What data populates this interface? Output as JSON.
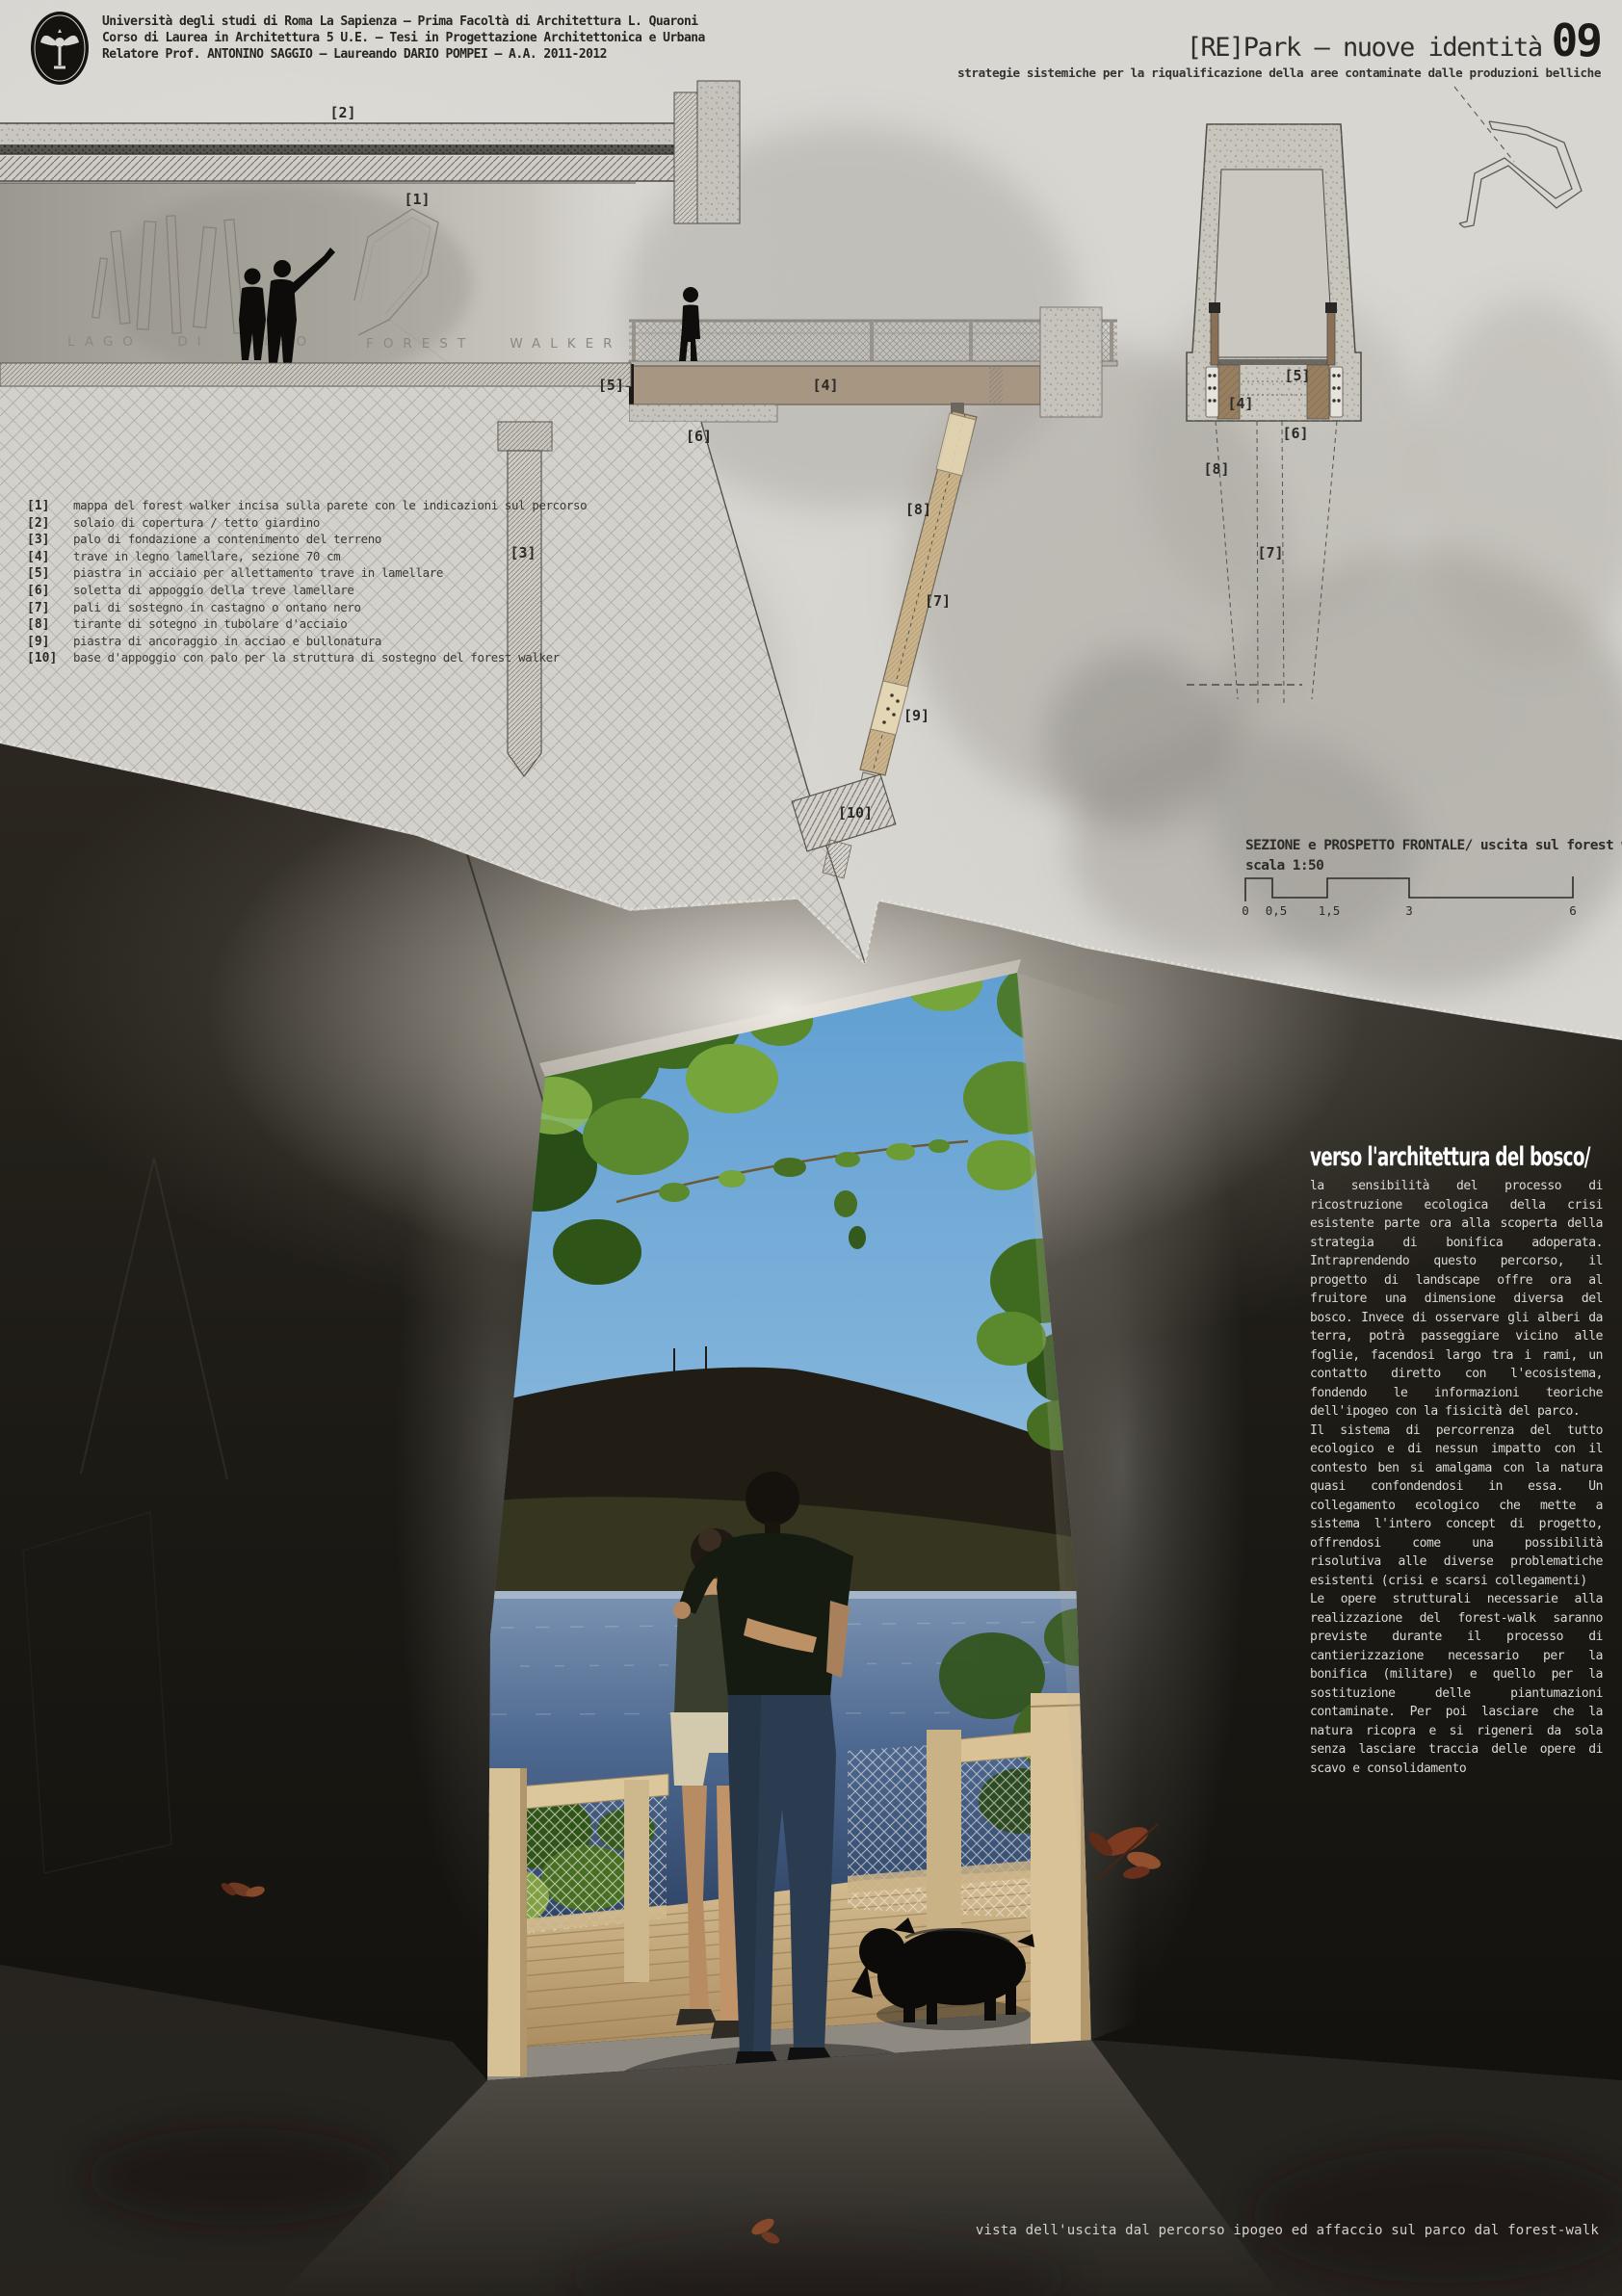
{
  "header": {
    "line1": "Università degli studi di Roma La Sapienza – Prima Facoltà di Architettura L. Quaroni",
    "line2": "Corso di Laurea in Architettura 5 U.E. – Tesi in Progettazione Architettonica e Urbana",
    "line3": "Relatore Prof. ANTONINO SAGGIO – Laureando DARIO POMPEI – A.A. 2011-2012",
    "title": "[RE]Park – nuove identità",
    "title_number": "09",
    "subtitle": "strategie sistemiche per la riqualificazione della aree contaminate dalle produzioni belliche"
  },
  "drawing": {
    "site_label_left": "LAGO DI VICO",
    "site_label_right": "FOREST WALKER",
    "callouts": {
      "c1": "[1]",
      "c2": "[2]",
      "c3": "[3]",
      "c4": "[4]",
      "c5": "[5]",
      "c6": "[6]",
      "c7": "[7]",
      "c8": "[8]",
      "c9": "[9]",
      "c10": "[10]"
    },
    "portal_callouts": {
      "p4": "[4]",
      "p5": "[5]",
      "p6": "[6]",
      "p7": "[7]",
      "p8": "[8]"
    },
    "caption_line1": "SEZIONE e PROSPETTO FRONTALE/ uscita sul forest walker",
    "caption_line2": "scala 1:50",
    "scale_ticks": [
      "0",
      "0,5",
      "1,5",
      "3",
      "6"
    ]
  },
  "legend": {
    "items": [
      {
        "num": "[1]",
        "text": "mappa del forest walker incisa sulla parete con le indicazioni sul percorso"
      },
      {
        "num": "[2]",
        "text": "solaio di copertura / tetto giardino"
      },
      {
        "num": "[3]",
        "text": "palo di fondazione a contenimento del terreno"
      },
      {
        "num": "[4]",
        "text": "trave in legno lamellare, sezione 70 cm"
      },
      {
        "num": "[5]",
        "text": "piastra in acciaio per allettamento trave in lamellare"
      },
      {
        "num": "[6]",
        "text": "soletta di appoggio della treve lamellare"
      },
      {
        "num": "[7]",
        "text": "pali di sostegno in castagno o ontano nero"
      },
      {
        "num": "[8]",
        "text": "tirante di sotegno in tubolare d'acciaio"
      },
      {
        "num": "[9]",
        "text": "piastra di ancoraggio in acciao e bullonatura"
      },
      {
        "num": "[10]",
        "text": "base d'appoggio con palo per la struttura di sostegno del forest walker"
      }
    ]
  },
  "essay": {
    "heading": "verso l'architettura del bosco/",
    "paragraphs": [
      "la sensibilità del processo di ricostruzione ecologica della crisi esistente parte ora alla scoperta della strategia di bonifica adoperata. Intraprendendo questo percorso, il progetto di landscape offre ora al fruitore una dimensione diversa del bosco. Invece di osservare gli alberi da terra, potrà passeggiare vicino alle foglie, facendosi largo tra i rami, un contatto diretto con l'ecosistema, fondendo le informazioni teoriche dell'ipogeo con la fisicità del parco.",
      "Il sistema di percorrenza del tutto ecologico e di nessun impatto con il contesto ben si amalgama con la natura quasi confondendosi in essa. Un collegamento ecologico che mette a sistema l'intero concept di progetto, offrendosi come una possibilità risolutiva alle diverse problematiche esistenti (crisi e scarsi collegamenti)",
      "Le opere strutturali necessarie alla realizzazione del forest-walk saranno previste durante il processo di cantierizzazione necessario per la bonifica (militare) e quello per la sostituzione delle piantumazioni contaminate. Per poi lasciare che la natura ricopra e si rigeneri da sola senza lasciare traccia delle opere di scavo e consolidamento"
    ]
  },
  "footer": {
    "caption": "vista dell'uscita dal percorso ipogeo ed affaccio sul parco dal forest-walk"
  },
  "colors": {
    "paper": "#d8d6d1",
    "ink": "#2d2c29",
    "dark": "#1b1914",
    "wood_beam": "#a79681",
    "strut": "#cdb488",
    "deck": "#d6bf93",
    "sky": "#5f9ed2",
    "lake": "#2c4162",
    "foliage": "#4c7a2e",
    "leaf_red": "#7c3a20"
  }
}
